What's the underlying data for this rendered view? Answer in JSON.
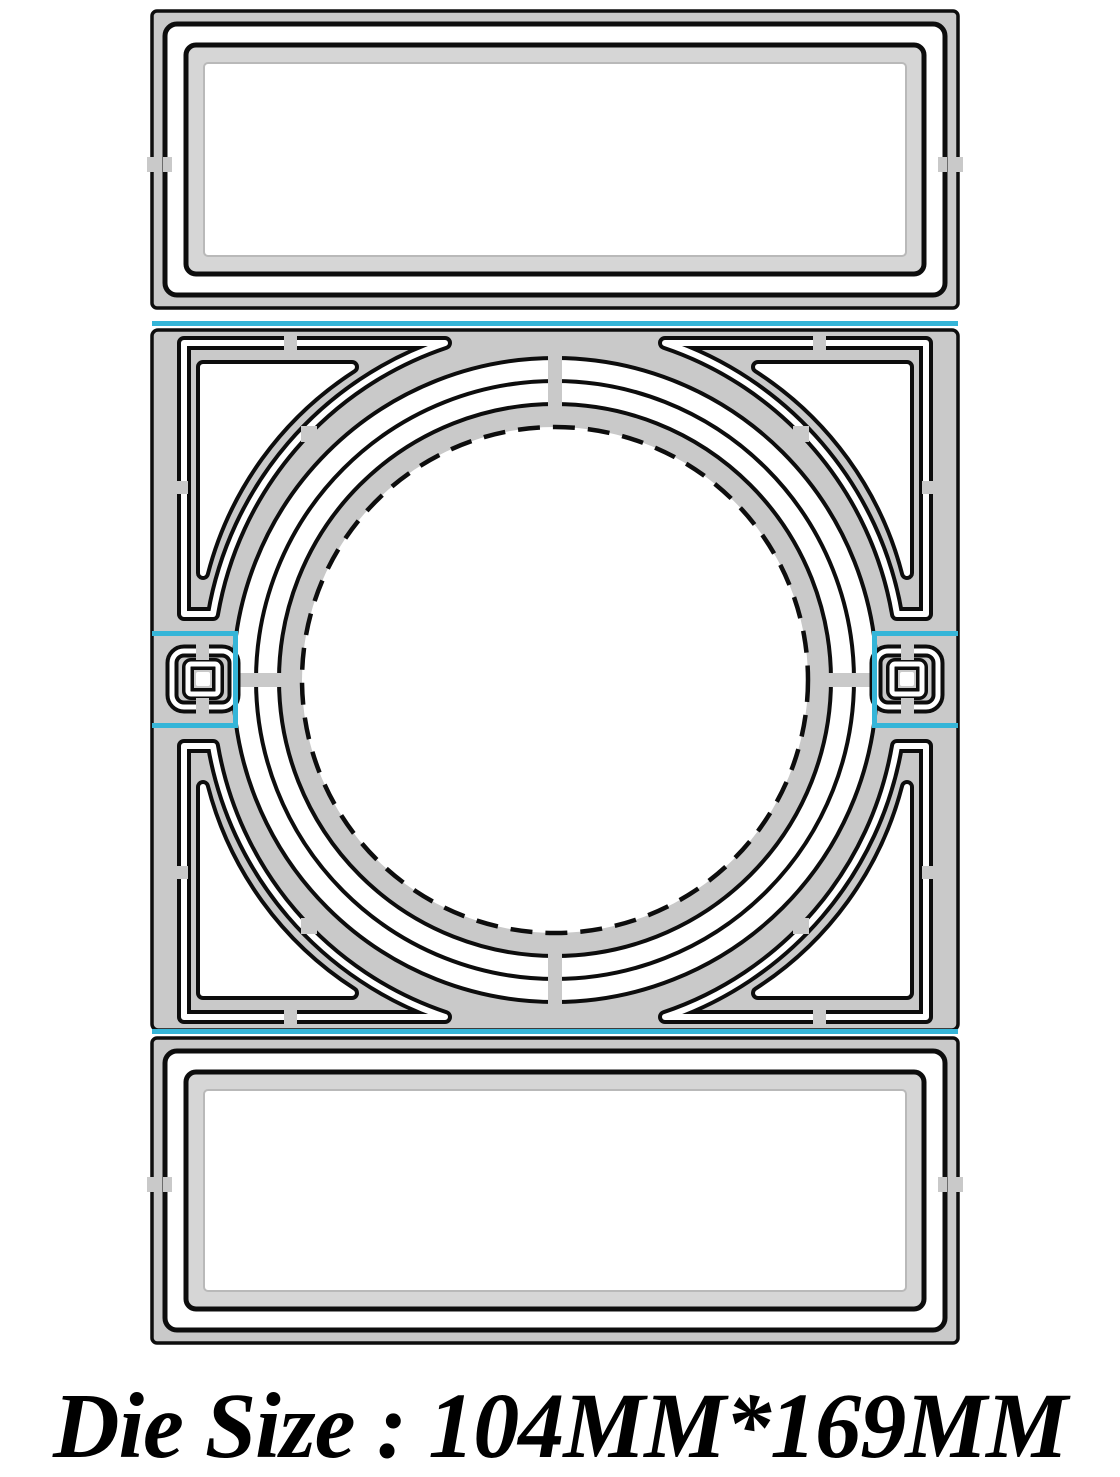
{
  "caption": {
    "text": "Die Size : 104MM*169MM"
  },
  "die_size": {
    "width": "104MM",
    "height": "169MM"
  },
  "colors": {
    "metal": "#c9c9c9",
    "metal_band": "#d6d6d6",
    "cut_line": "#0d0d0d",
    "registration_cyan": "#35b5d8",
    "cutout_white": "#ffffff",
    "background": "#ffffff"
  }
}
